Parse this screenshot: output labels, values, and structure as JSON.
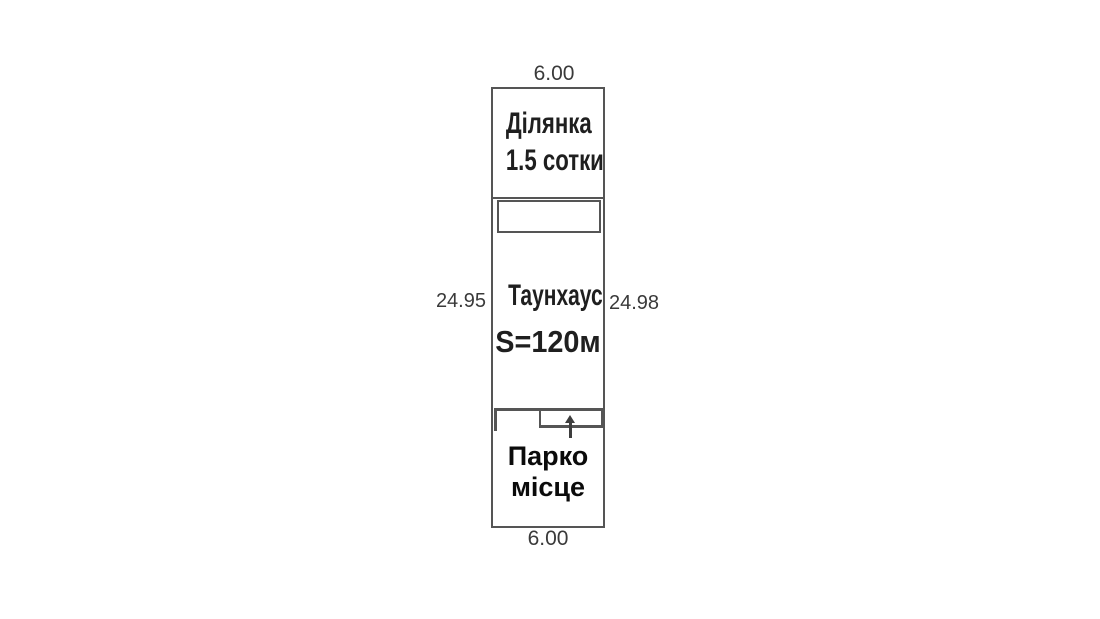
{
  "diagram": {
    "title": "land plot scheme with townhouse and parking",
    "dimensions": {
      "top_width": "6.00",
      "bottom_width": "6.00",
      "left_length": "24.95",
      "right_length": "24.98"
    },
    "plot": {
      "label_line1": "Ділянка",
      "label_line2": "1.5 сотки"
    },
    "house": {
      "name": "Таунхаус",
      "area": "S=120м"
    },
    "parking": {
      "label_line1": "Парко",
      "label_line2": "місце"
    }
  },
  "colors": {
    "line": "#555555",
    "text-dark": "#1f1f1f",
    "dim": "#3a3a3a",
    "parking": "#0b0b0b",
    "bg": "#ffffff"
  }
}
